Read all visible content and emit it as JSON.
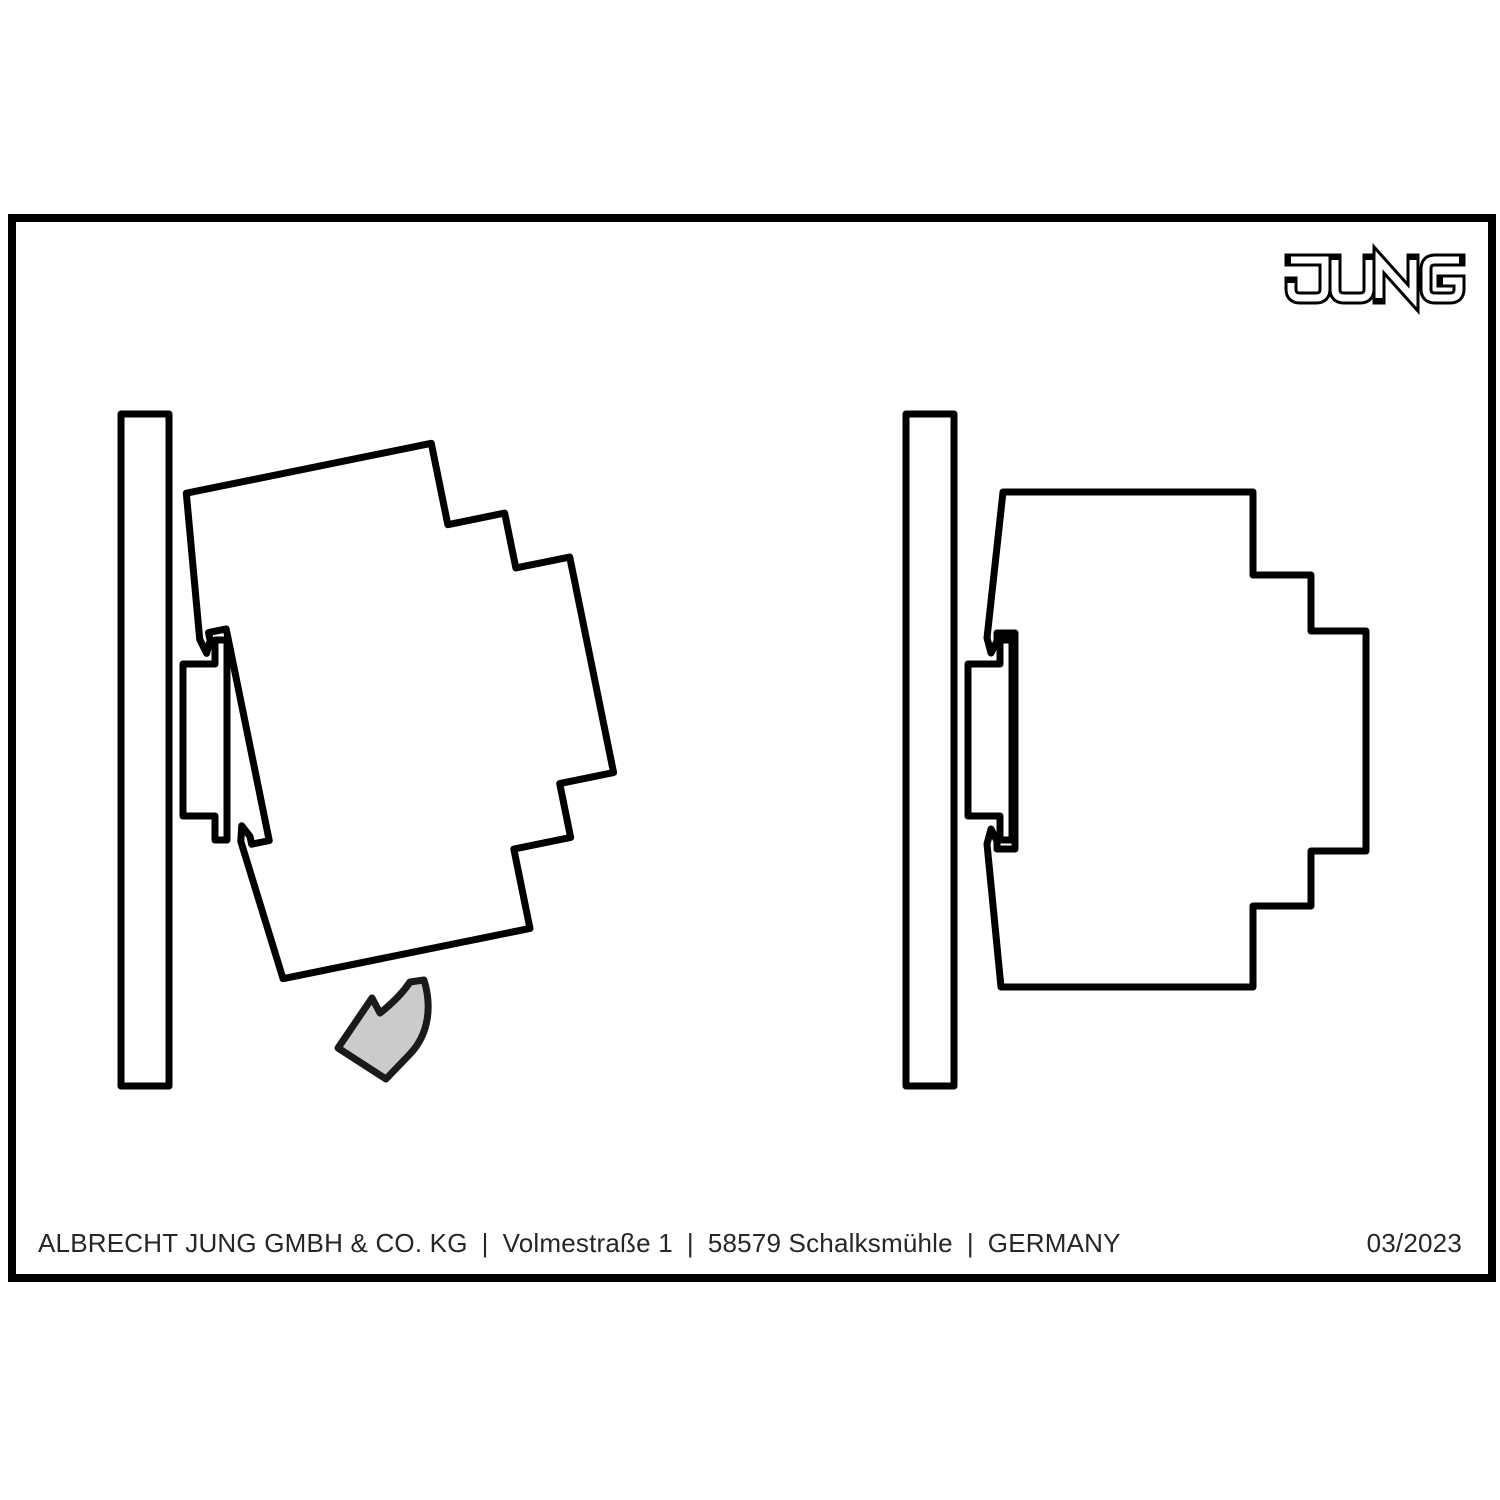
{
  "brand": {
    "name": "JUNG"
  },
  "footer": {
    "company": "ALBRECHT JUNG GMBH & CO. KG",
    "street": "Volmestraße 1",
    "city": "58579 Schalksmühle",
    "country": "GERMANY",
    "separator": "|",
    "issue": "03/2023"
  },
  "colors": {
    "wall_fill": "#d5d5d5",
    "device_fill": "#ffffff",
    "outline": "#000000",
    "arrow_fill": "#cbcbcb",
    "arrow_stroke": "#1a1a1a"
  }
}
